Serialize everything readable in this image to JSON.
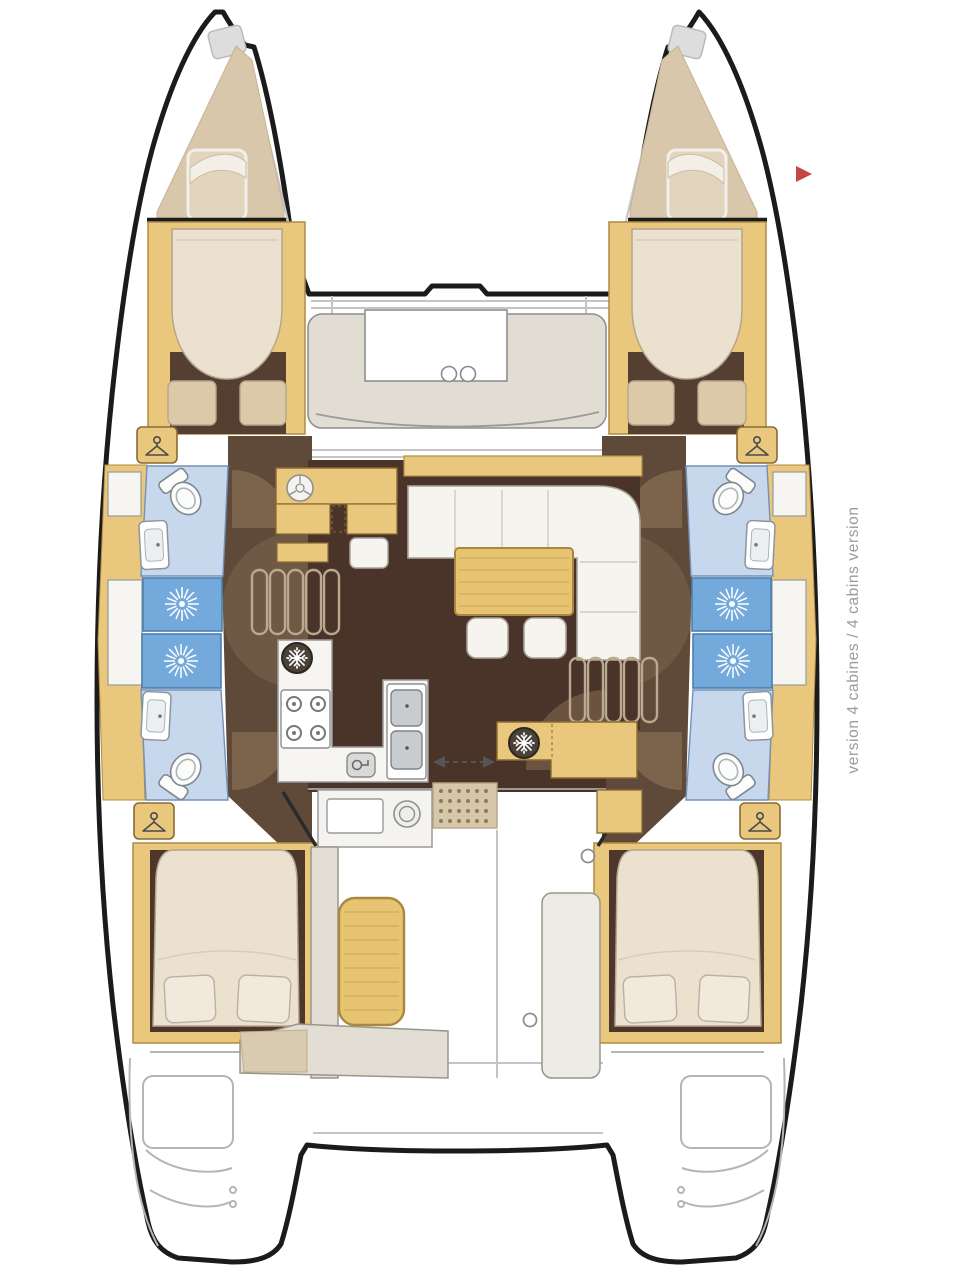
{
  "annotation": {
    "version_label": "version 4 cabines / 4 cabins version",
    "color": "#9a9a9a"
  },
  "markers": {
    "red_arrow": {
      "shape": "right-pointing-triangle",
      "color": "#c64545"
    }
  },
  "plan": {
    "type": "catamaran-floorplan",
    "icons": [
      "hanger-icon",
      "shower-head-icon",
      "toilet-icon",
      "sink-icon",
      "stove-burners-icon",
      "fridge-snowflake-icon",
      "faucet-icon",
      "cupholder-icon",
      "sliding-door-arrow-icon",
      "nav-instrument-icon",
      "red-arrow-icon"
    ]
  },
  "palette": {
    "outline_black": "#1b1b1b",
    "deck_line_gray": "#bcbcbc",
    "wood_yellow": "#e9c87e",
    "wood_stroke": "#b08c44",
    "teak": "#e7c472",
    "bed_cream": "#ebe1ce",
    "bed_tan": "#dcc9a8",
    "floor_dark_brown": "#4a342a",
    "corridor_brown": "#5f4a39",
    "fan_brown": "#a08363",
    "seat_beige": "#e3ded3",
    "bath_blue": "#c7d8ed",
    "shower_blue": "#74a9dc",
    "mat_beige": "#d5c7a7",
    "appliance_dark": "#4a4138"
  }
}
